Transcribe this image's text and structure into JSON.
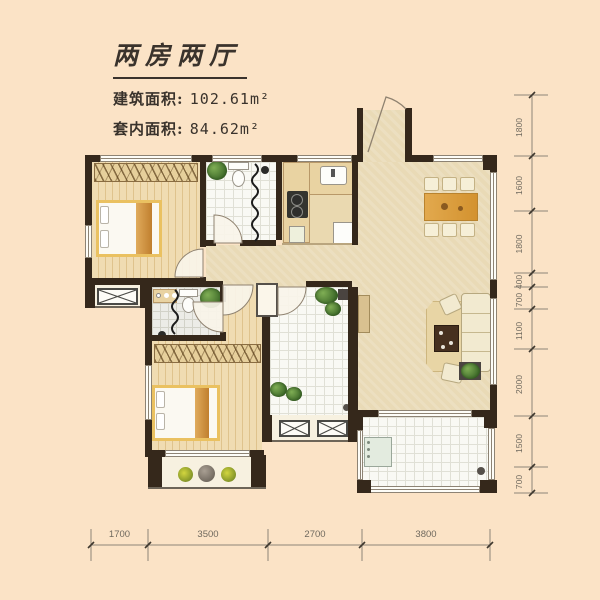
{
  "title": {
    "text": "两房两厅"
  },
  "areas": {
    "building_label": "建筑面积:",
    "building_value": "102.61m²",
    "inner_label": "套内面积:",
    "inner_value": "84.62m²"
  },
  "dimensions": {
    "right": [
      "1800",
      "1600",
      "1800",
      "400",
      "700",
      "1100",
      "2000",
      "1500",
      "700"
    ],
    "bottom": [
      "1700",
      "3500",
      "2700",
      "3800"
    ]
  },
  "colors": {
    "background": "#fbe3c6",
    "wall": "#35281b",
    "wood_floor": "#eed9ab",
    "hall_floor": "#e9dab6",
    "tile_white": "#f9f9f4",
    "tile_gray": "#ecece7",
    "bed_accent": "#d9a257",
    "table_wood": "#dfa44a",
    "plant_green": "#4e7c38",
    "dim_text": "#6f695e"
  }
}
